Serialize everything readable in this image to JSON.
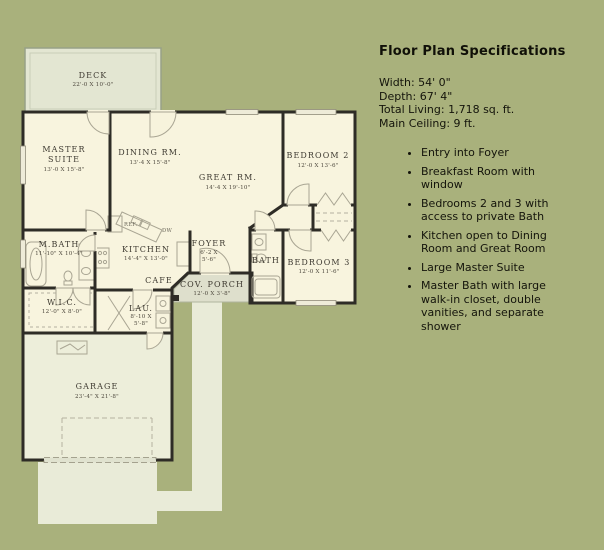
{
  "plan": {
    "deck": {
      "label": "DECK",
      "dims": "22'-0 X 10'-0\""
    },
    "rooms": {
      "master": {
        "line1": "MASTER",
        "line2": "SUITE",
        "dims": "13'-0 X 15'-8\""
      },
      "dining": {
        "label": "DINING RM.",
        "dims": "13'-4 X 15'-8\""
      },
      "great": {
        "label": "GREAT RM.",
        "dims": "14'-4 X 19'-10\""
      },
      "bedroom2": {
        "label": "BEDROOM 2",
        "dims": "12'-0 X 13'-6\""
      },
      "mbath": {
        "label": "M.BATH",
        "dims": "11'-10\" X 10'-4\""
      },
      "kitchen": {
        "label": "KITCHEN",
        "dims": "14'-4\" X 13'-0\""
      },
      "cafe": {
        "label": "CAFE"
      },
      "foyer": {
        "label": "FOYER",
        "dims1": "6'-2 X",
        "dims2": "5'-6\""
      },
      "bath": {
        "label": "BATH"
      },
      "bedroom3": {
        "label": "BEDROOM 3",
        "dims": "12'-0 X 11'-6\""
      },
      "porch": {
        "label": "COV. PORCH",
        "dims": "12'-0 X 3'-8\""
      },
      "wic": {
        "label": "W.I.C.",
        "dims": "12'-0\" X 8'-0\""
      },
      "laundry": {
        "label": "LAU.",
        "dims1": "8'-10 X",
        "dims2": "5'-8\""
      },
      "garage": {
        "label": "GARAGE",
        "dims": "23'-4\" X 21'-8\""
      }
    },
    "appliances": {
      "ref": "REF.",
      "dw": "DW"
    },
    "colors": {
      "background": "#a9b17c",
      "wall": "#2e2c26",
      "floor": "#f8f4de",
      "garage_floor": "#edeeda",
      "deck": "#e3e6d2",
      "porch": "#dedfcc",
      "paving": "#e9ebd8"
    }
  },
  "specs": {
    "title": "Floor Plan Specifications",
    "lines": [
      "Width: 54' 0\"",
      "Depth: 67' 4\"",
      "Total Living: 1,718 sq. ft.",
      "Main Ceiling: 9 ft."
    ],
    "bullets": [
      "Entry into Foyer",
      "Breakfast Room with window",
      "Bedrooms 2 and 3 with access to private Bath",
      "Kitchen open to Dining Room and Great Room",
      "Large Master Suite",
      "Master Bath with large walk-in closet, double vanities, and separate shower"
    ]
  }
}
